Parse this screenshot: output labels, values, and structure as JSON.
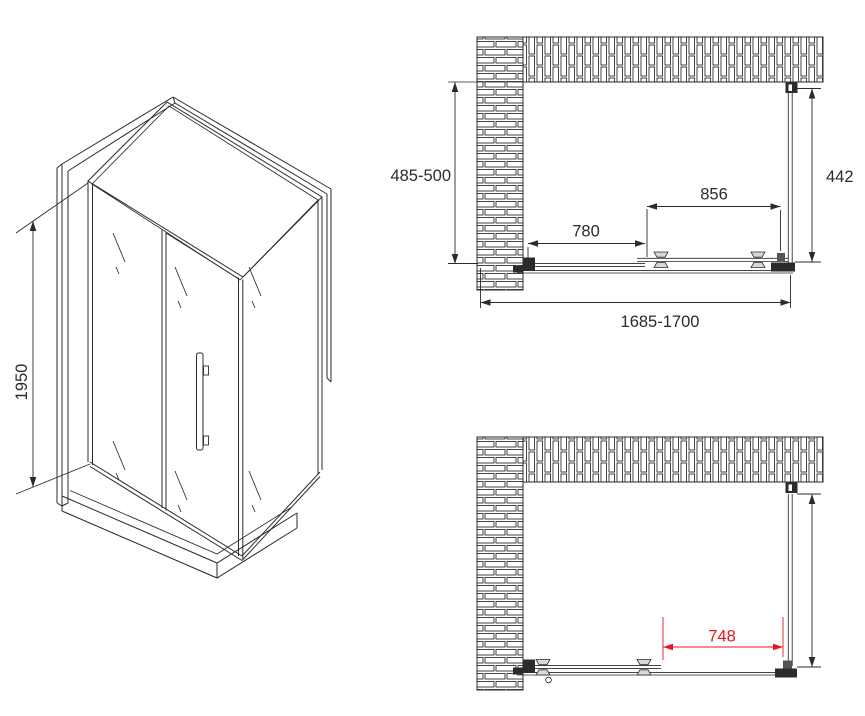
{
  "colors": {
    "line": "#2b2b2b",
    "dimension_red": "#e8151c",
    "background": "#ffffff"
  },
  "isometric_view": {
    "height_dim": "1950"
  },
  "plan_view_closed": {
    "depth_dim": "485-500",
    "side_panel_dim": "442",
    "door_glass_dim": "856",
    "fixed_glass_dim": "780",
    "width_dim": "1685-1700"
  },
  "plan_view_open": {
    "opening_dim": "748"
  }
}
